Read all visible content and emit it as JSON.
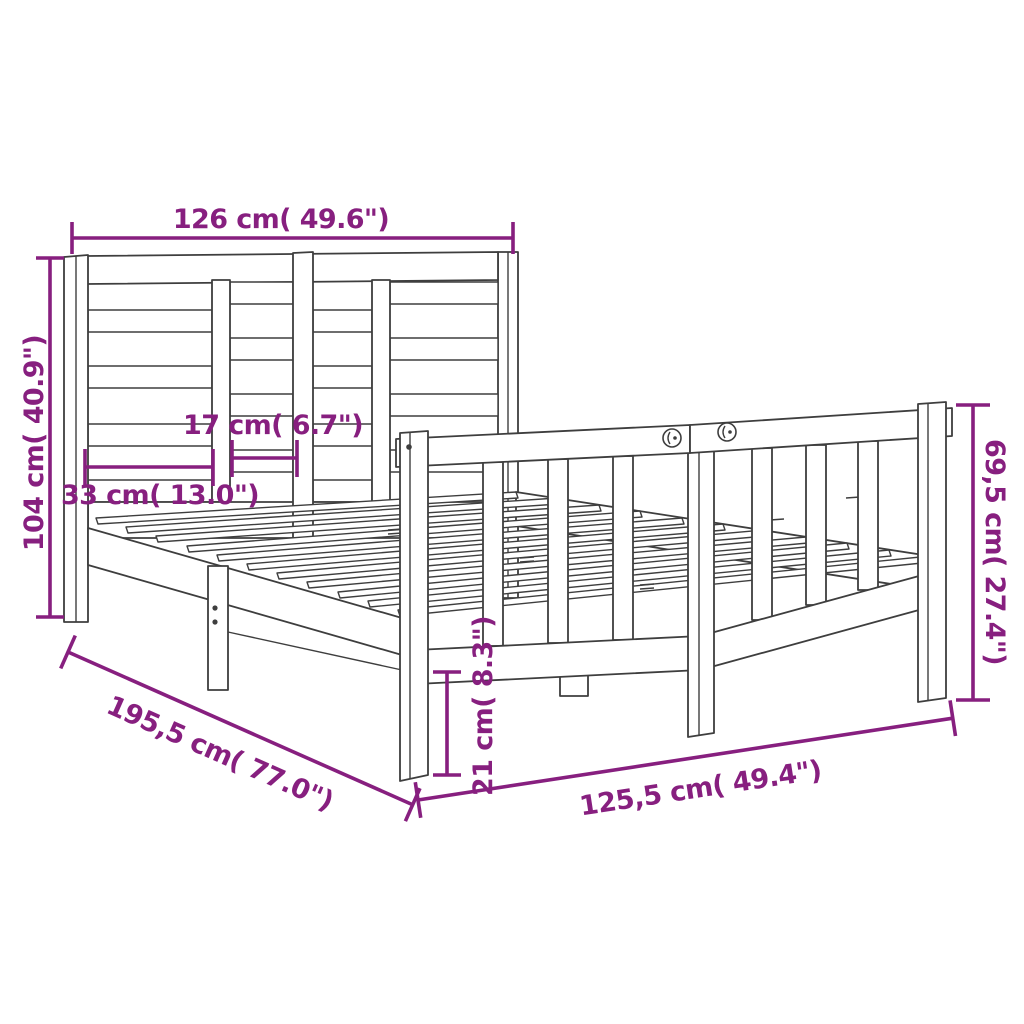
{
  "diagram": {
    "type": "product-dimension-drawing",
    "colors": {
      "dimension": "#871f7f",
      "line": "#3e3e3e",
      "background": "#ffffff"
    },
    "dimensions": [
      {
        "id": "headboard-width",
        "cm": "126",
        "inches": "49.6",
        "label": "126 cm( 49.6\")"
      },
      {
        "id": "headboard-height",
        "cm": "104",
        "inches": "40.9",
        "label": "104 cm( 40.9\")"
      },
      {
        "id": "panel-gap-small",
        "cm": "17",
        "inches": "6.7",
        "label": "17 cm( 6.7\")"
      },
      {
        "id": "panel-gap-large",
        "cm": "33",
        "inches": "13.0",
        "label": "33 cm( 13.0\")"
      },
      {
        "id": "footboard-height",
        "cm": "69,5",
        "inches": "27.4",
        "label": "69,5 cm( 27.4\")"
      },
      {
        "id": "rail-clearance",
        "cm": "21",
        "inches": "8.3",
        "label": "21 cm( 8.3\")"
      },
      {
        "id": "frame-length",
        "cm": "195,5",
        "inches": "77.0",
        "label": "195,5 cm( 77.0\")"
      },
      {
        "id": "frame-width",
        "cm": "125,5",
        "inches": "49.4",
        "label": "125,5 cm( 49.4\")"
      }
    ]
  }
}
